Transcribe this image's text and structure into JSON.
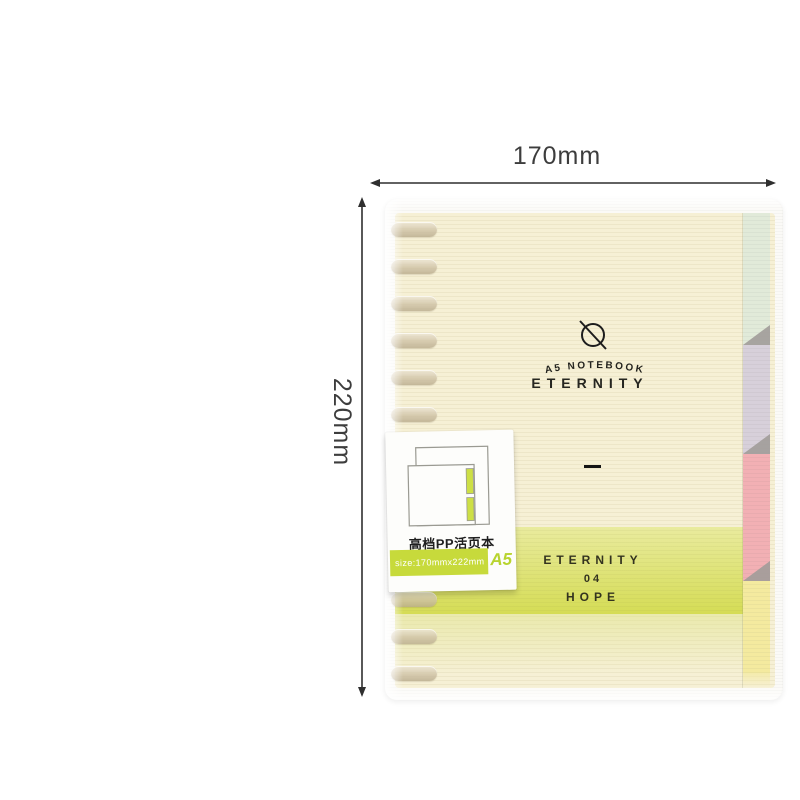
{
  "page": {
    "background": "#ffffff"
  },
  "dimension_annotations": {
    "width_label": "170mm",
    "height_label": "220mm",
    "arrow_color": "#2f2f2f"
  },
  "notebook": {
    "logo_icon": "circle-slash",
    "subtitle": "A5 NOTEBOOK",
    "title": "ETERNITY",
    "cover_color": "#f6f0d5",
    "band": {
      "line1": "ETERNITY",
      "line2": "04",
      "line3": "HOPE",
      "color_top": "#e9eb9e",
      "color_bottom": "#d5dc55"
    },
    "tabs": [
      {
        "name": "tab-mint",
        "color": "#e1ead9"
      },
      {
        "name": "tab-lavender",
        "color": "#d7d0da"
      },
      {
        "name": "tab-pink",
        "color": "#f2b0b4"
      },
      {
        "name": "tab-yellow",
        "color": "#f4ea9f"
      }
    ],
    "tab_divider_color": "#a19c99",
    "ring_count": 13,
    "ring_color": "#cfc2a6"
  },
  "label_tag": {
    "title": "高档PP活页本",
    "size_text": "size:170mmx222mm",
    "size_badge": "A5",
    "strip_color": "#c7da3b"
  }
}
